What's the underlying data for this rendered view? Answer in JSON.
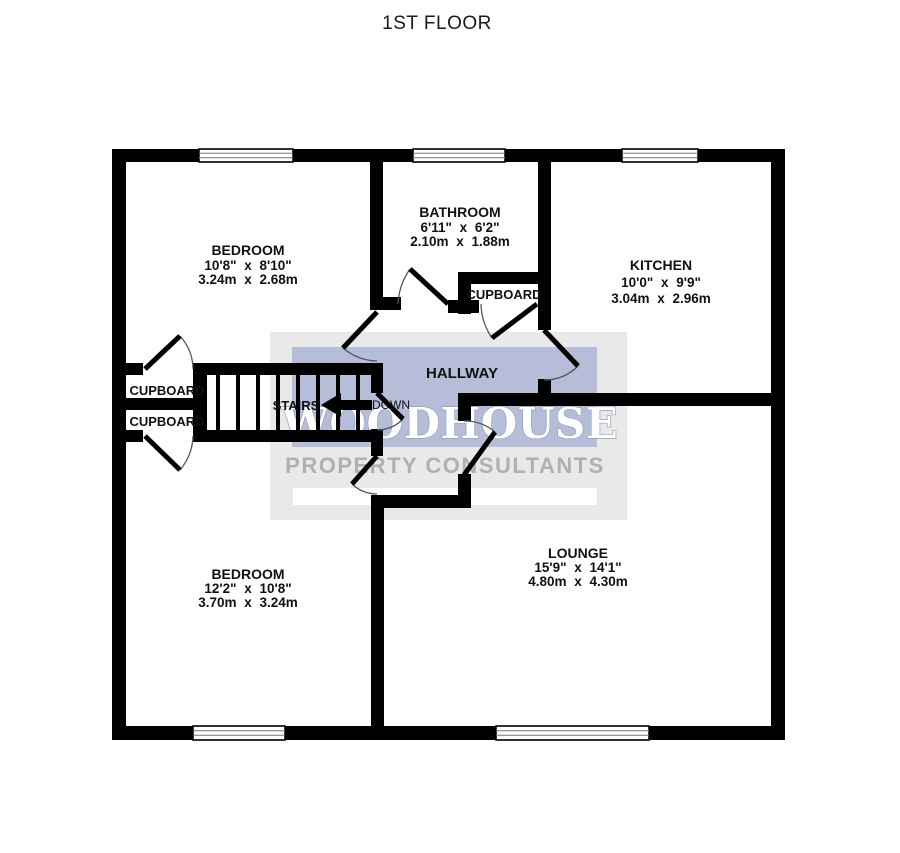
{
  "title": "1ST FLOOR",
  "watermark": {
    "name": "WOODHOUSE",
    "tagline": "PROPERTY CONSULTANTS"
  },
  "rooms": {
    "bedroom1": {
      "name": "BEDROOM",
      "imperial": "10'8\" x 8'10\"",
      "metric": "3.24m x 2.68m"
    },
    "bathroom": {
      "name": "BATHROOM",
      "imperial": "6'11\" x 6'2\"",
      "metric": "2.10m x 1.88m"
    },
    "kitchen": {
      "name": "KITCHEN",
      "imperial": "10'0\" x 9'9\"",
      "metric": "3.04m x 2.96m"
    },
    "bedroom2": {
      "name": "BEDROOM",
      "imperial": "12'2\" x 10'8\"",
      "metric": "3.70m x 3.24m"
    },
    "lounge": {
      "name": "LOUNGE",
      "imperial": "15'9\" x 14'1\"",
      "metric": "4.80m x 4.30m"
    },
    "hallway": {
      "name": "HALLWAY"
    },
    "cupboard_left_top": {
      "name": "CUPBOARD"
    },
    "cupboard_left_bottom": {
      "name": "CUPBOARD"
    },
    "cupboard_hall": {
      "name": "CUPBOARD"
    }
  },
  "stairs": {
    "label": "STAIRS",
    "direction": "DOWN"
  },
  "colors": {
    "wall": "#000000",
    "background": "#ffffff",
    "watermark_gray": "#e9e9e9",
    "watermark_blue": "#b5bdd9",
    "watermark_strip": "#ffffff",
    "woodhouse_fill": "#ffffff",
    "woodhouse_outline": "#96a1c0",
    "tagline_gray": "#b0b0b0",
    "label_text": "#111111"
  }
}
